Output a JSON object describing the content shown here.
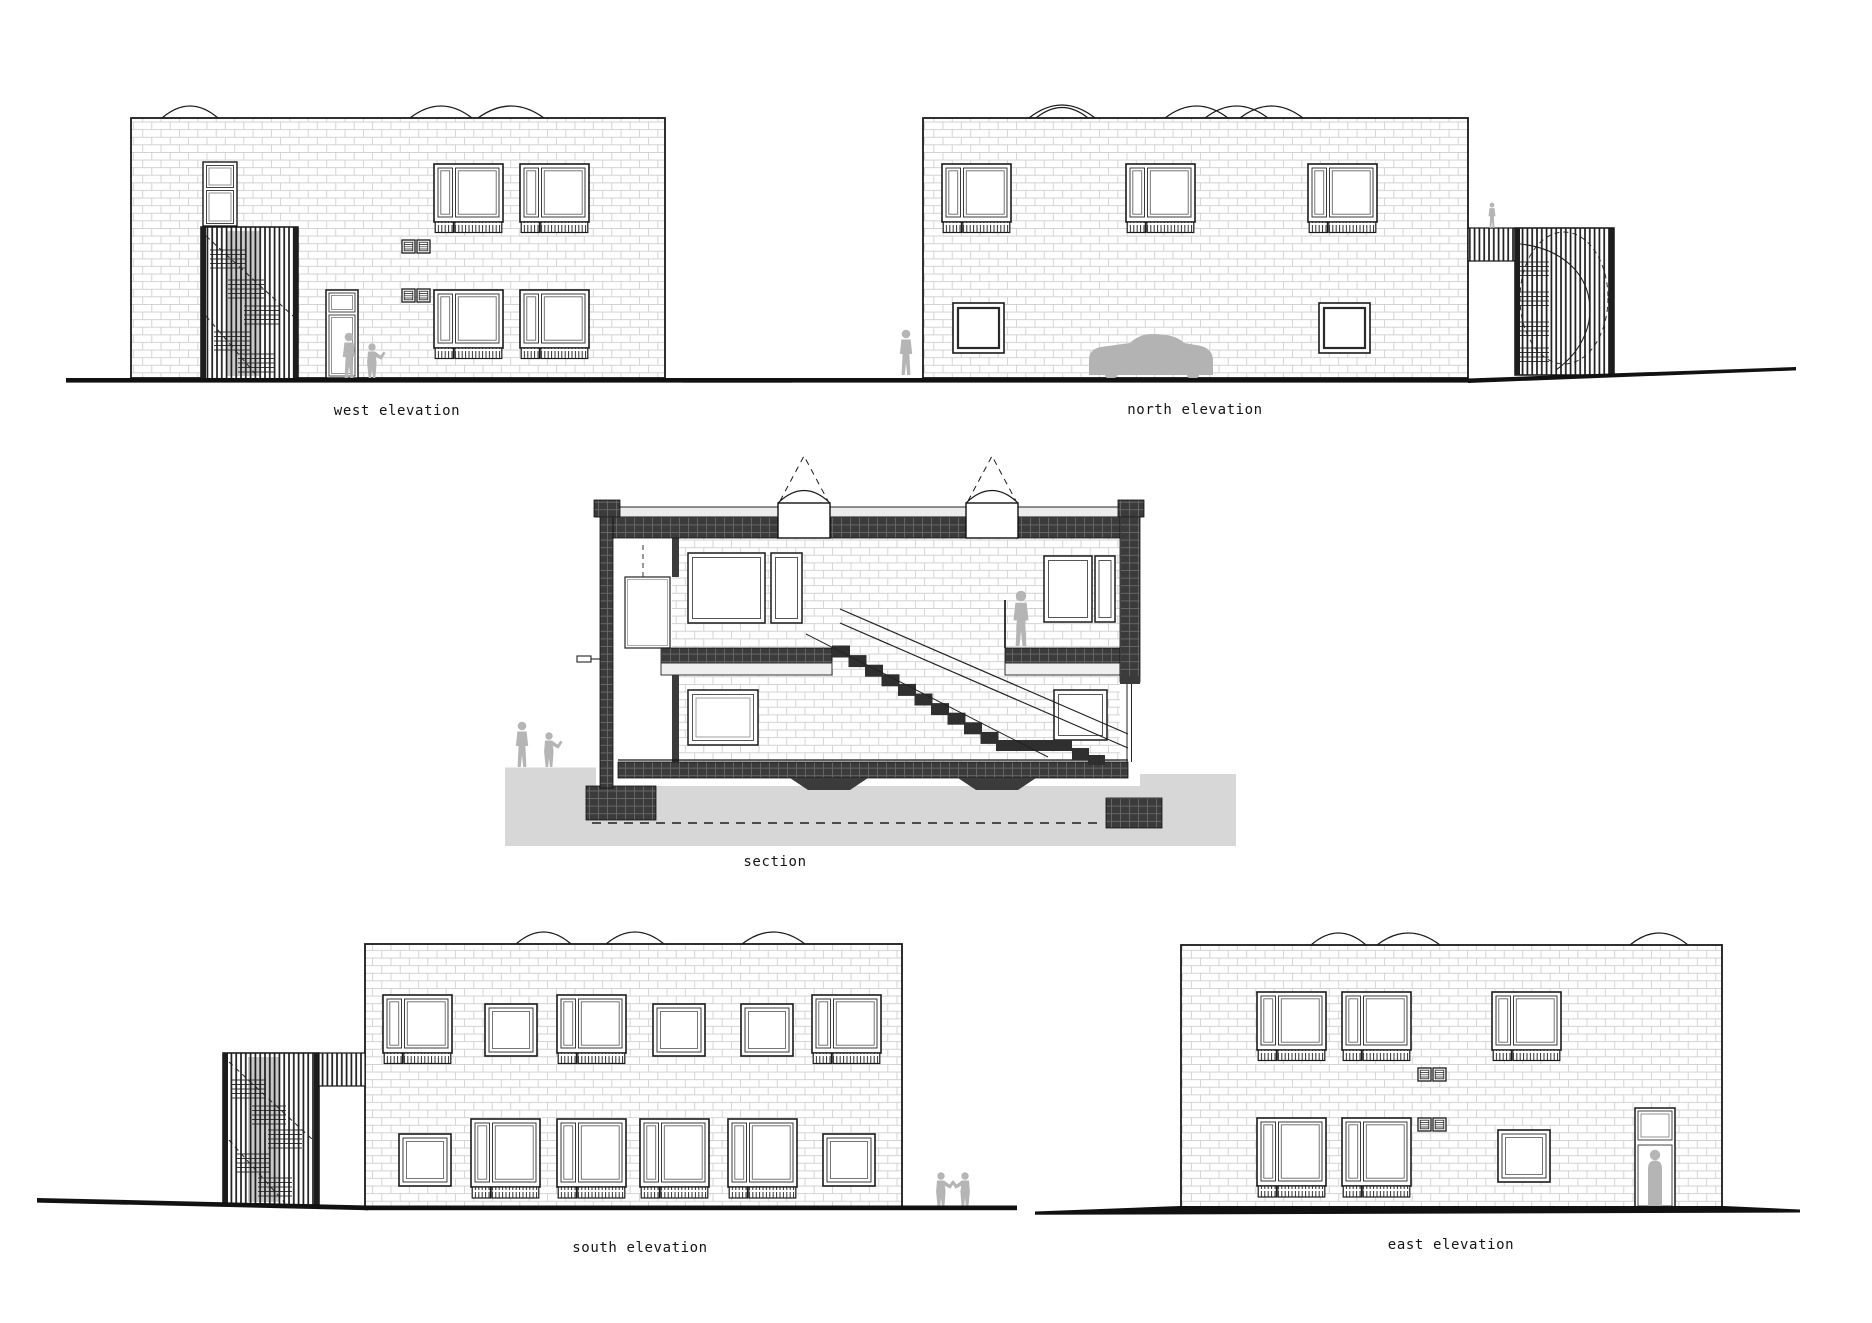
{
  "sheet": {
    "width": 1872,
    "height": 1323,
    "background": "#ffffff",
    "type": "architectural drawing sheet"
  },
  "drawings": [
    {
      "id": "west-elevation",
      "label": "west elevation"
    },
    {
      "id": "north-elevation",
      "label": "north elevation"
    },
    {
      "id": "section",
      "label": "section"
    },
    {
      "id": "south-elevation",
      "label": "south elevation"
    },
    {
      "id": "east-elevation",
      "label": "east elevation"
    }
  ],
  "colors": {
    "line": "#1a1a1a",
    "brick_joint": "#cccccc",
    "cut_wall_fill": "#3b3b3b",
    "ground_mass_fill": "#d7d7d7",
    "ground_line": "#111111",
    "silhouette": "#b5b5b5",
    "label_text": "#141414"
  }
}
